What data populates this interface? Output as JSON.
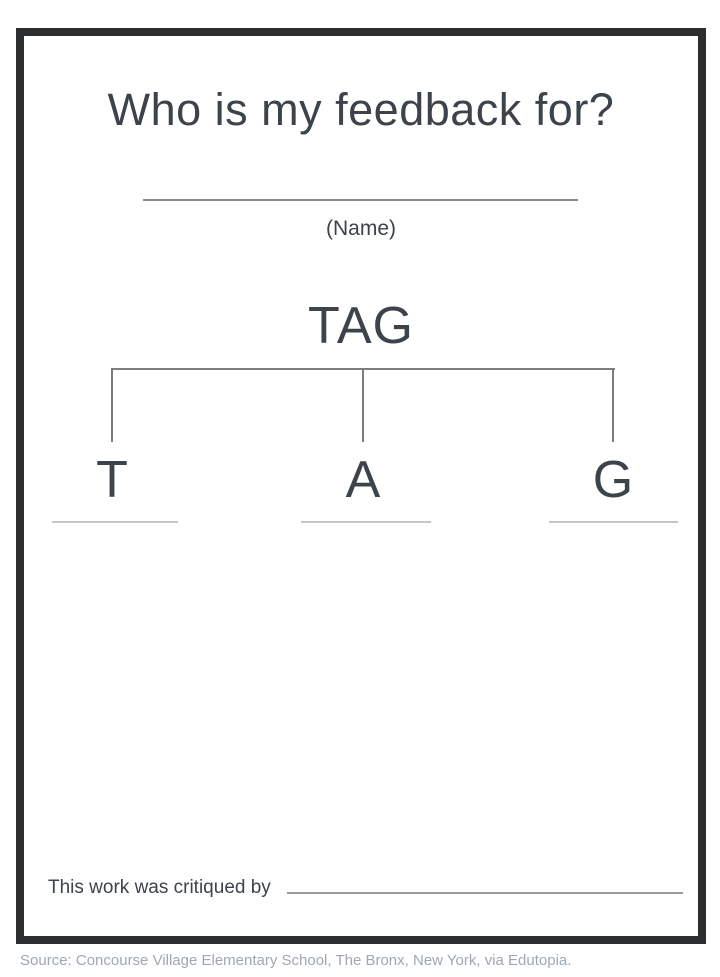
{
  "page": {
    "title": "Who is my feedback for?",
    "name_line_label": "(Name)",
    "tree": {
      "root": "TAG",
      "branches": [
        {
          "letter": "T"
        },
        {
          "letter": "A"
        },
        {
          "letter": "G"
        }
      ]
    },
    "footer": {
      "critiqued_label": "This work was critiqued by"
    },
    "source": "Source: Concourse Village Elementary School, The Bronx, New York, via Edutopia.",
    "colors": {
      "frame": "#2d2e30",
      "text": "#3d434b",
      "connector_line": "#7d7d7d",
      "name_line": "#8c8c8c",
      "branch_underline": "#c6c6c6",
      "critiqued_line": "#9b9b9b",
      "source_text": "#9ea8b3"
    }
  }
}
